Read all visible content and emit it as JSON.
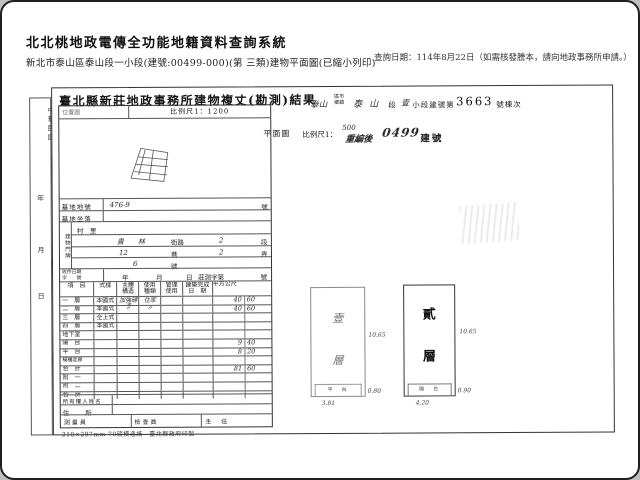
{
  "header": {
    "system_title": "北北桃地政電傳全功能地籍資料查詢系統",
    "subtitle": "新北市泰山區泰山段一小段(建號:00499-000)(第 三類)建物平面圖(已縮小列印)",
    "query_date": "查詢日期：114年8月22日（如需核發謄本，請向地政事務所申請。）"
  },
  "doc": {
    "title": "臺北縣新莊地政事務所建物複丈(勘測)結果",
    "margin": {
      "era": "中華民國",
      "year": "年",
      "month": "月",
      "day": "日",
      "extra": "簽之"
    },
    "location": {
      "box_label": "位置圖",
      "scale": "比例尺1：1200"
    },
    "jurisdiction": {
      "hand_pre": "泰山",
      "stamp_top": "區市",
      "stamp_bottom": "鄉鎮",
      "sec_hand": "泰山",
      "sec_label": "段",
      "subsec_hand": "壹",
      "subsec_label": "小段建號第",
      "bldg_no": "3663",
      "suffix": "號棟次"
    },
    "plan_line": {
      "plan": "平面圖",
      "scale_label": "比例尺1：",
      "scale_value": "500",
      "re_label": "重編後",
      "re_no": "0499",
      "re_suffix": "建號"
    },
    "form": {
      "base_no": {
        "label": "基地地號",
        "value": "476-9",
        "unit": "號"
      },
      "base_loc": {
        "label": "基地坐落"
      },
      "door": {
        "group": "建物門牌",
        "village": "村　里",
        "street_val": "貴林",
        "street_label": "街路",
        "sec_val": "2",
        "sec_label": "段",
        "lane_val": "12",
        "lane_label": "巷",
        "alley_val": "2",
        "alley_label": "弄",
        "no_val": "6",
        "no_label": "號"
      },
      "receipt": {
        "label": "收件日期\n字　　號",
        "y": "年",
        "m": "月",
        "d": "日",
        "word": "莊測字第",
        "tail": "號"
      },
      "area_table": {
        "headers": [
          [
            "項　目"
          ],
          [
            "式樣"
          ],
          [
            "主體",
            "構造"
          ],
          [
            "使用",
            "種類"
          ],
          [
            "管理",
            "使用"
          ],
          [
            "建築完成",
            "日　期"
          ],
          [
            "平方公尺"
          ]
        ],
        "rows": [
          {
            "item": "一　層",
            "style": "本國式",
            "structure": "加強磚造",
            "use": "住家",
            "mgmt": "",
            "date": "",
            "a1": "40",
            "a2": "60"
          },
          {
            "item": "二　層",
            "style": "本國式",
            "structure": "〃",
            "use": "〃",
            "mgmt": "",
            "date": "",
            "a1": "40",
            "a2": "60"
          },
          {
            "item": "三　層",
            "style": "仝上式",
            "structure": "",
            "use": "",
            "mgmt": "",
            "date": "",
            "a1": "",
            "a2": ""
          },
          {
            "item": "四　層",
            "style": "本國式",
            "structure": "",
            "use": "",
            "mgmt": "",
            "date": "",
            "a1": "",
            "a2": ""
          },
          {
            "item": "地下室",
            "style": "",
            "structure": "",
            "use": "",
            "mgmt": "",
            "date": "",
            "a1": "",
            "a2": ""
          },
          {
            "item": "陽　台",
            "style": "",
            "structure": "",
            "use": "",
            "mgmt": "",
            "date": "",
            "a1": "9",
            "a2": "40"
          },
          {
            "item": "平　台",
            "style": "",
            "structure": "",
            "use": "",
            "mgmt": "",
            "date": "",
            "a1": "8",
            "a2": "20"
          },
          {
            "item": "騎樓走廊",
            "style": "",
            "structure": "",
            "use": "",
            "mgmt": "",
            "date": "",
            "a1": "",
            "a2": ""
          },
          {
            "item": "合　計",
            "style": "",
            "structure": "",
            "use": "",
            "mgmt": "",
            "date": "",
            "a1": "81",
            "a2": "60"
          },
          {
            "item": "附　一",
            "style": "",
            "structure": "",
            "use": "",
            "mgmt": "",
            "date": "",
            "a1": "",
            "a2": ""
          },
          {
            "item": "附　二",
            "style": "",
            "structure": "",
            "use": "",
            "mgmt": "",
            "date": "",
            "a1": "",
            "a2": ""
          },
          {
            "item": "合　計",
            "style": "",
            "structure": "",
            "use": "",
            "mgmt": "",
            "date": "",
            "a1": "",
            "a2": ""
          }
        ]
      },
      "owner_label": "所有權人姓名",
      "address_label": "住　　所",
      "signoff": [
        "測量員",
        "檢查員",
        "主　任"
      ]
    },
    "footer_note": "210×297mm 70磅模造紙　臺北縣政府印製",
    "drawings": {
      "left": {
        "floor1": "壹",
        "floor2": "層",
        "strip": "平　台",
        "h": "10.65",
        "s": "0.80",
        "w": "3.81"
      },
      "right": {
        "floor1": "貳",
        "floor2": "層",
        "strip": "陽　台",
        "h": "10.65",
        "s": "0.90",
        "w": "4.20"
      }
    }
  }
}
